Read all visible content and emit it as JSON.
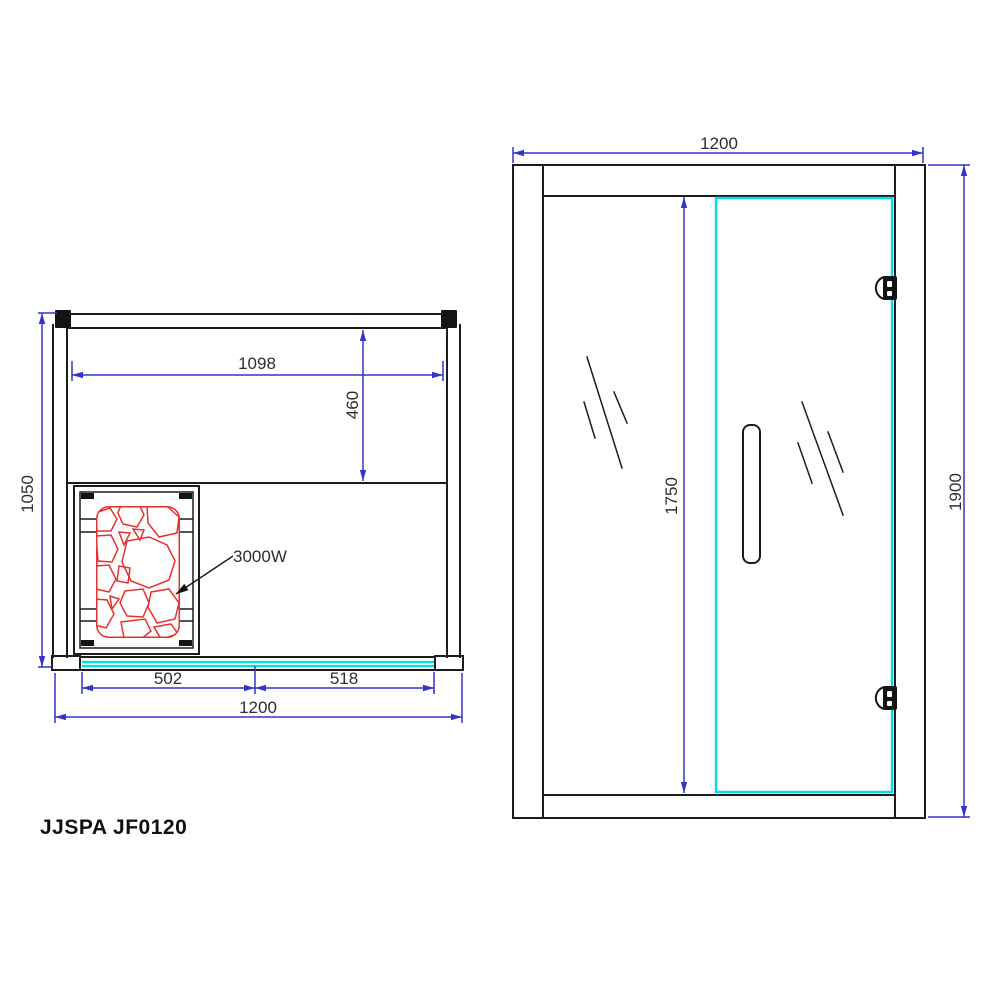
{
  "title": "JJSPA JF0120",
  "colors": {
    "line": "#1c1c1c",
    "dimension": "#3434cd",
    "glass": "#00dfe4",
    "heater": "#e8302e"
  },
  "plan_view": {
    "dims": {
      "overall_width": "1200",
      "overall_depth": "1050",
      "interior_width": "1098",
      "bench_depth": "460",
      "glass_left": "502",
      "glass_right": "518"
    },
    "heater_label": "3000W"
  },
  "front_view": {
    "dims": {
      "overall_width": "1200",
      "overall_height": "1900",
      "door_height": "1750"
    }
  }
}
